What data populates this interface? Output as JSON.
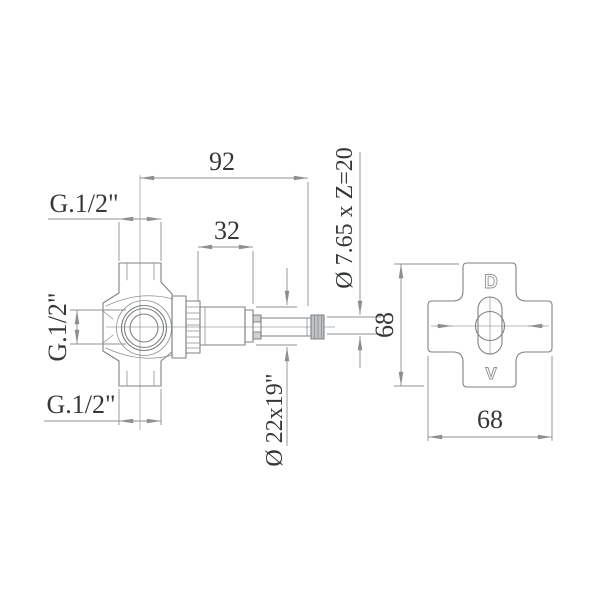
{
  "colors": {
    "background": "#ffffff",
    "line": "#8b8f91",
    "text": "#35383a"
  },
  "side_view": {
    "dim_total_length": "92",
    "dim_cartridge_length": "32",
    "thread_top": "G.1/2\"",
    "thread_center": "G.1/2\"",
    "thread_bottom": "G.1/2\"",
    "dim_stem_diameter": "Ø 22x19\"",
    "dim_spline": "Ø 7.65 x Z=20"
  },
  "front_view": {
    "dim_height": "68",
    "dim_width": "68",
    "port_top": "D",
    "port_bottom": "V"
  }
}
